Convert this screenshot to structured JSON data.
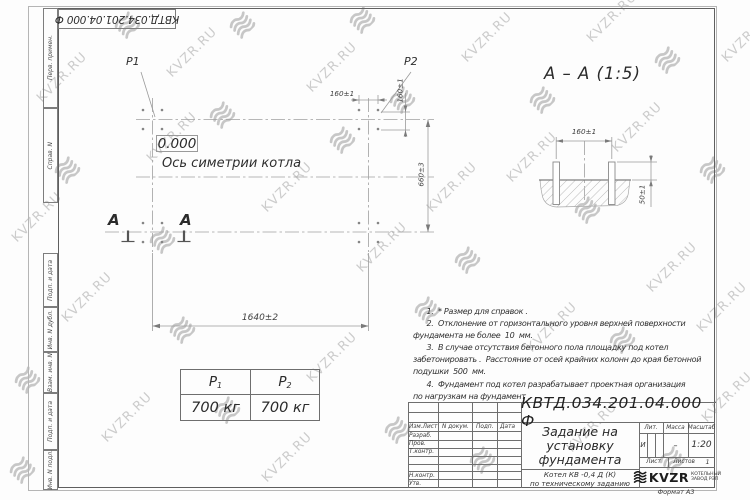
{
  "sheet": {
    "doc_number": "КВТД.034.201.04.000  Ф",
    "format_label": "Формат А3"
  },
  "watermark": {
    "text": "KVZR.RU"
  },
  "margin_fields": {
    "perv_primen": "Перв. примен.",
    "sprav_n": "Справ. N",
    "podp_data_1": "Подп. и дата",
    "inv_n_dubl": "Инв. N дубл.",
    "vzam_inv_n": "Взам. инв. N",
    "podp_data_2": "Подп. и дата",
    "inv_n_podl": "Инв. N подл."
  },
  "plan": {
    "p1_label": "P1",
    "p2_label": "P2",
    "level_mark": "0.000",
    "axis_label": "Ось симетрии котла",
    "dim_width": "1640±2",
    "dim_height": "660±3",
    "dim_bolt_pitch_h": "160±1",
    "dim_bolt_pitch_v": "160±1",
    "section_letter": "А"
  },
  "section_view": {
    "title": "А – А (1:5)",
    "dim_bolt_spacing": "160±1",
    "dim_protrusion": "50±1"
  },
  "load_table": {
    "headers": [
      {
        "label": "P",
        "sub": "1"
      },
      {
        "label": "P",
        "sub": "2"
      }
    ],
    "values": [
      "700 кг",
      "700 кг"
    ]
  },
  "notes": {
    "lines": [
      "      1.  * Размер для справок .",
      "      2.  Отклонение от горизонтального уровня верхней поверхности",
      "фундамента не более  10  мм.",
      "      3.  В случае отсутствия бетонного пола площадку под котел",
      "забетонировать .  Расстояние от осей крайних колонн до края бетонной",
      "подушки  500  мм.",
      "      4.  Фундамент под котел разрабатывает проектная организация",
      "по нагрузкам на фундамент ."
    ]
  },
  "title_block": {
    "doc_number": "КВТД.034.201.04.000  Ф",
    "title": "Задание на установку фундамента",
    "subtitle_line1": "Котел  КВ -0,4  Д  (К)",
    "subtitle_line2": "по техническому заданию",
    "col_izm": "Изм.Лист",
    "col_doc": "N докум.",
    "col_podp": "Подп.",
    "col_data": "Дата",
    "row_razrab": "Разраб.",
    "row_prov": "Пров.",
    "row_tkontr": "Т.контр.",
    "row_nkontr": "Н.контр.",
    "row_utv": "Утв.",
    "lit_header": "Лит.",
    "mass_header": "Масса",
    "scale_header": "Масштаб",
    "lit_value": "И",
    "mass_value": "–",
    "scale_value": "1:20",
    "sheet_label": "Лист",
    "sheets_label": "Листов",
    "sheets_value": "1",
    "logo_text": "KVZR",
    "logo_caption1": "КОТЕЛЬНЫЙ",
    "logo_caption2": "ЗАВОД РЭП"
  }
}
